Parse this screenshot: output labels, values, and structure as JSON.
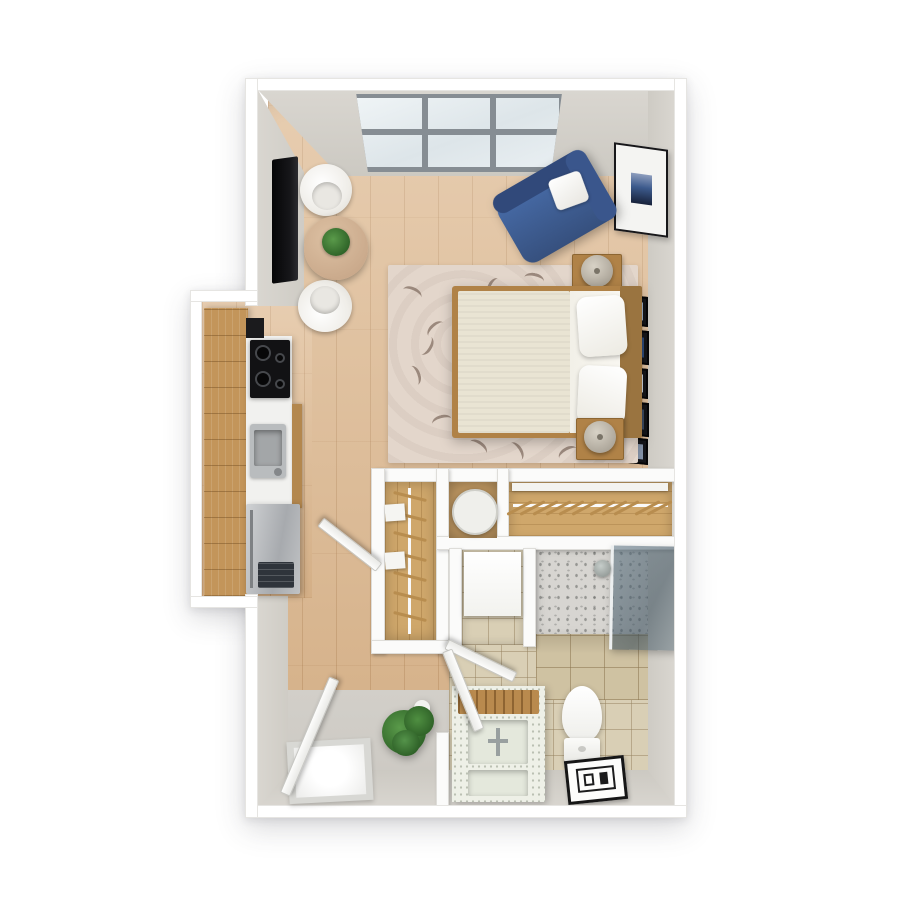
{
  "meta": {
    "title": "3D top-down floor plan render of a studio apartment",
    "style": "photoreal 3D dollhouse view, white walls, light oak flooring"
  },
  "palette": {
    "wall": "#ffffff",
    "wallface": "#d3d0c9",
    "wood": "#deba92",
    "woodline": "#96642e",
    "tile": "#d9cfb5",
    "tileline": "#998457",
    "tilewall": "#cfc2a2",
    "rug": "#e3d6cb",
    "chaise": "#3d5a94",
    "cabinet": "#c3955a",
    "counter": "#f1f1ef",
    "steel": "#b9bcbe",
    "duvet": "#e9e4d3",
    "bedframe": "#b08247",
    "closetwood": "#cfa76b",
    "plantc": "#3f7d36",
    "glass": "#5d7382",
    "entryfloor": "#cbc8c2",
    "showerfloor": "#d7d5d1",
    "vanity": "#eef0e7"
  },
  "rooms": {
    "living": {
      "label": "Living / sleeping area"
    },
    "kitchen": {
      "label": "Kitchen nook"
    },
    "closets": {
      "label": "Closet area"
    },
    "bathroom": {
      "label": "Bathroom"
    },
    "entry": {
      "label": "Entry"
    }
  },
  "furniture": {
    "window": {
      "label": "Three-section window, 6 panes"
    },
    "tv": {
      "label": "Wall-mounted flat TV"
    },
    "bistro_table": {
      "label": "Round bistro table"
    },
    "table_plant": {
      "label": "Small potted plant"
    },
    "chair_top": {
      "label": "White tub chair"
    },
    "chair_bottom": {
      "label": "White tub chair"
    },
    "chaise": {
      "label": "Blue chaise lounge with white pillow"
    },
    "wall_art": {
      "label": "Framed abstract wall art"
    },
    "gallery": {
      "label": "Column of photo frames"
    },
    "rug": {
      "label": "Beige area rug with leaf pattern"
    },
    "bed": {
      "label": "Bed with cream duvet and two white pillows"
    },
    "nightstand_top": {
      "label": "Nightstand with lamp"
    },
    "nightstand_bottom": {
      "label": "Nightstand with lamp"
    },
    "cabinets": {
      "label": "Oak kitchen cabinets"
    },
    "cooktop": {
      "label": "Black 4-burner cooktop"
    },
    "kitchen_sink": {
      "label": "Stainless kitchen sink"
    },
    "fridge": {
      "label": "Stainless refrigerator"
    },
    "closet_small": {
      "label": "Reach-in closet with rod and shelves"
    },
    "closet_long": {
      "label": "Long closet with hanging rod"
    },
    "washer": {
      "label": "Round-top appliance (washer)"
    },
    "utility_box": {
      "label": "White utility appliance"
    },
    "shower": {
      "label": "Walk-in shower with glass panel"
    },
    "shower_head": {
      "label": "Shower head"
    },
    "toilet": {
      "label": "Toilet"
    },
    "bath_mat": {
      "label": "Patterned bath mat"
    },
    "vanity": {
      "label": "Stone vanity with sink and wooden tray"
    },
    "entry_door": {
      "label": "Open entry door"
    },
    "bathroom_door": {
      "label": "Open bathroom door"
    },
    "closet_door": {
      "label": "Open closet door"
    },
    "utility_door": {
      "label": "Open utility closet door"
    },
    "door_mat": {
      "label": "Entry door mat"
    },
    "entry_plant": {
      "label": "Potted plant"
    }
  }
}
